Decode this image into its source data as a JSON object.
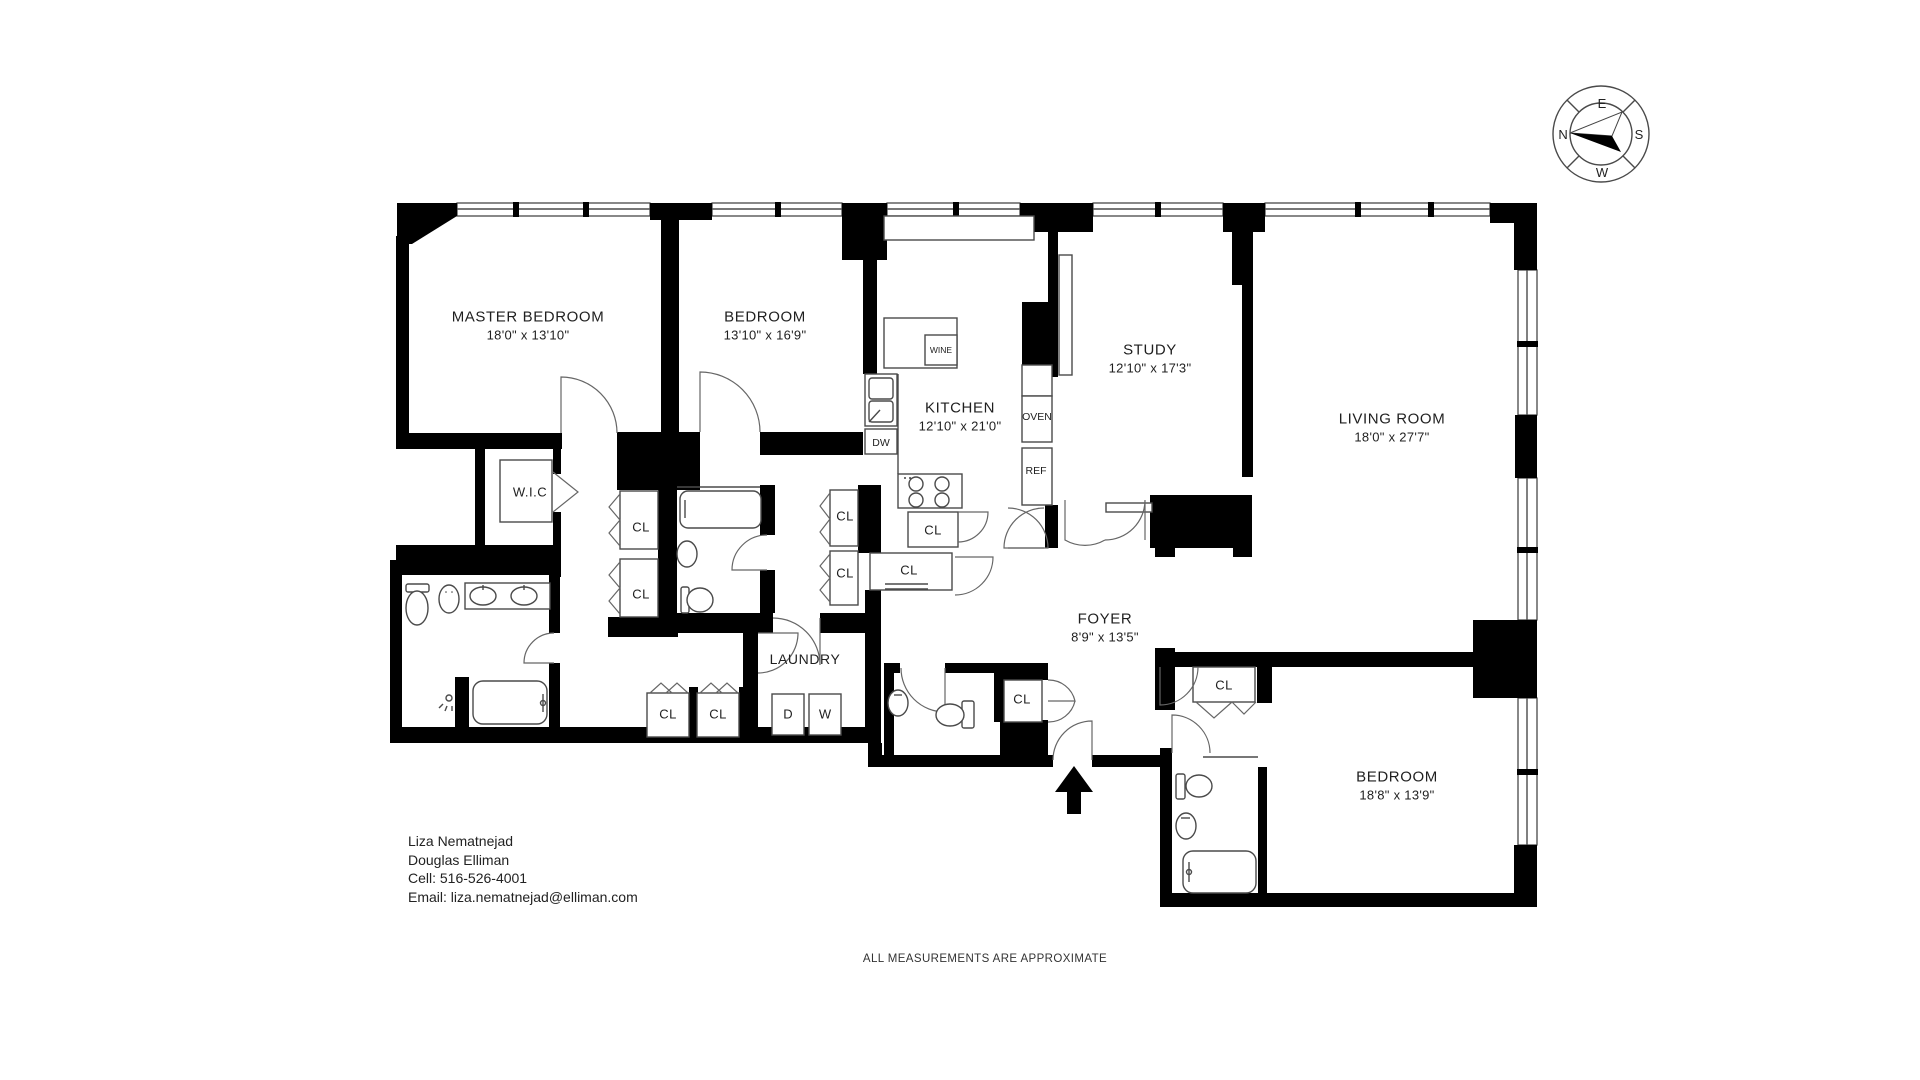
{
  "rooms": {
    "master_bedroom": {
      "name": "MASTER BEDROOM",
      "dims": "18'0\" x 13'10\""
    },
    "bedroom_2": {
      "name": "BEDROOM",
      "dims": "13'10\" x 16'9\""
    },
    "kitchen": {
      "name": "KITCHEN",
      "dims": "12'10\" x 21'0\""
    },
    "study": {
      "name": "STUDY",
      "dims": "12'10\" x 17'3\""
    },
    "living_room": {
      "name": "LIVING ROOM",
      "dims": "18'0\" x 27'7\""
    },
    "foyer": {
      "name": "FOYER",
      "dims": "8'9\" x 13'5\""
    },
    "bedroom_3": {
      "name": "BEDROOM",
      "dims": "18'8\" x 13'9\""
    },
    "laundry": {
      "name": "LAUNDRY"
    },
    "walk_in_closet": {
      "name": "W.I.C"
    }
  },
  "labels": {
    "closet": "CL",
    "wine": "WINE",
    "dishwasher": "DW",
    "oven": "OVEN",
    "refrigerator": "REF",
    "dryer": "D",
    "washer": "W"
  },
  "compass": {
    "north": "N",
    "east": "E",
    "south": "S",
    "west": "W"
  },
  "agent": {
    "name": "Liza Nematnejad",
    "company": "Douglas Elliman",
    "cell": "Cell: 516-526-4001",
    "email": "Email: liza.nematnejad@elliman.com"
  },
  "footer": "ALL MEASUREMENTS ARE APPROXIMATE",
  "colors": {
    "wall": "#000000",
    "line": "#4a4a4a",
    "background": "#ffffff"
  }
}
